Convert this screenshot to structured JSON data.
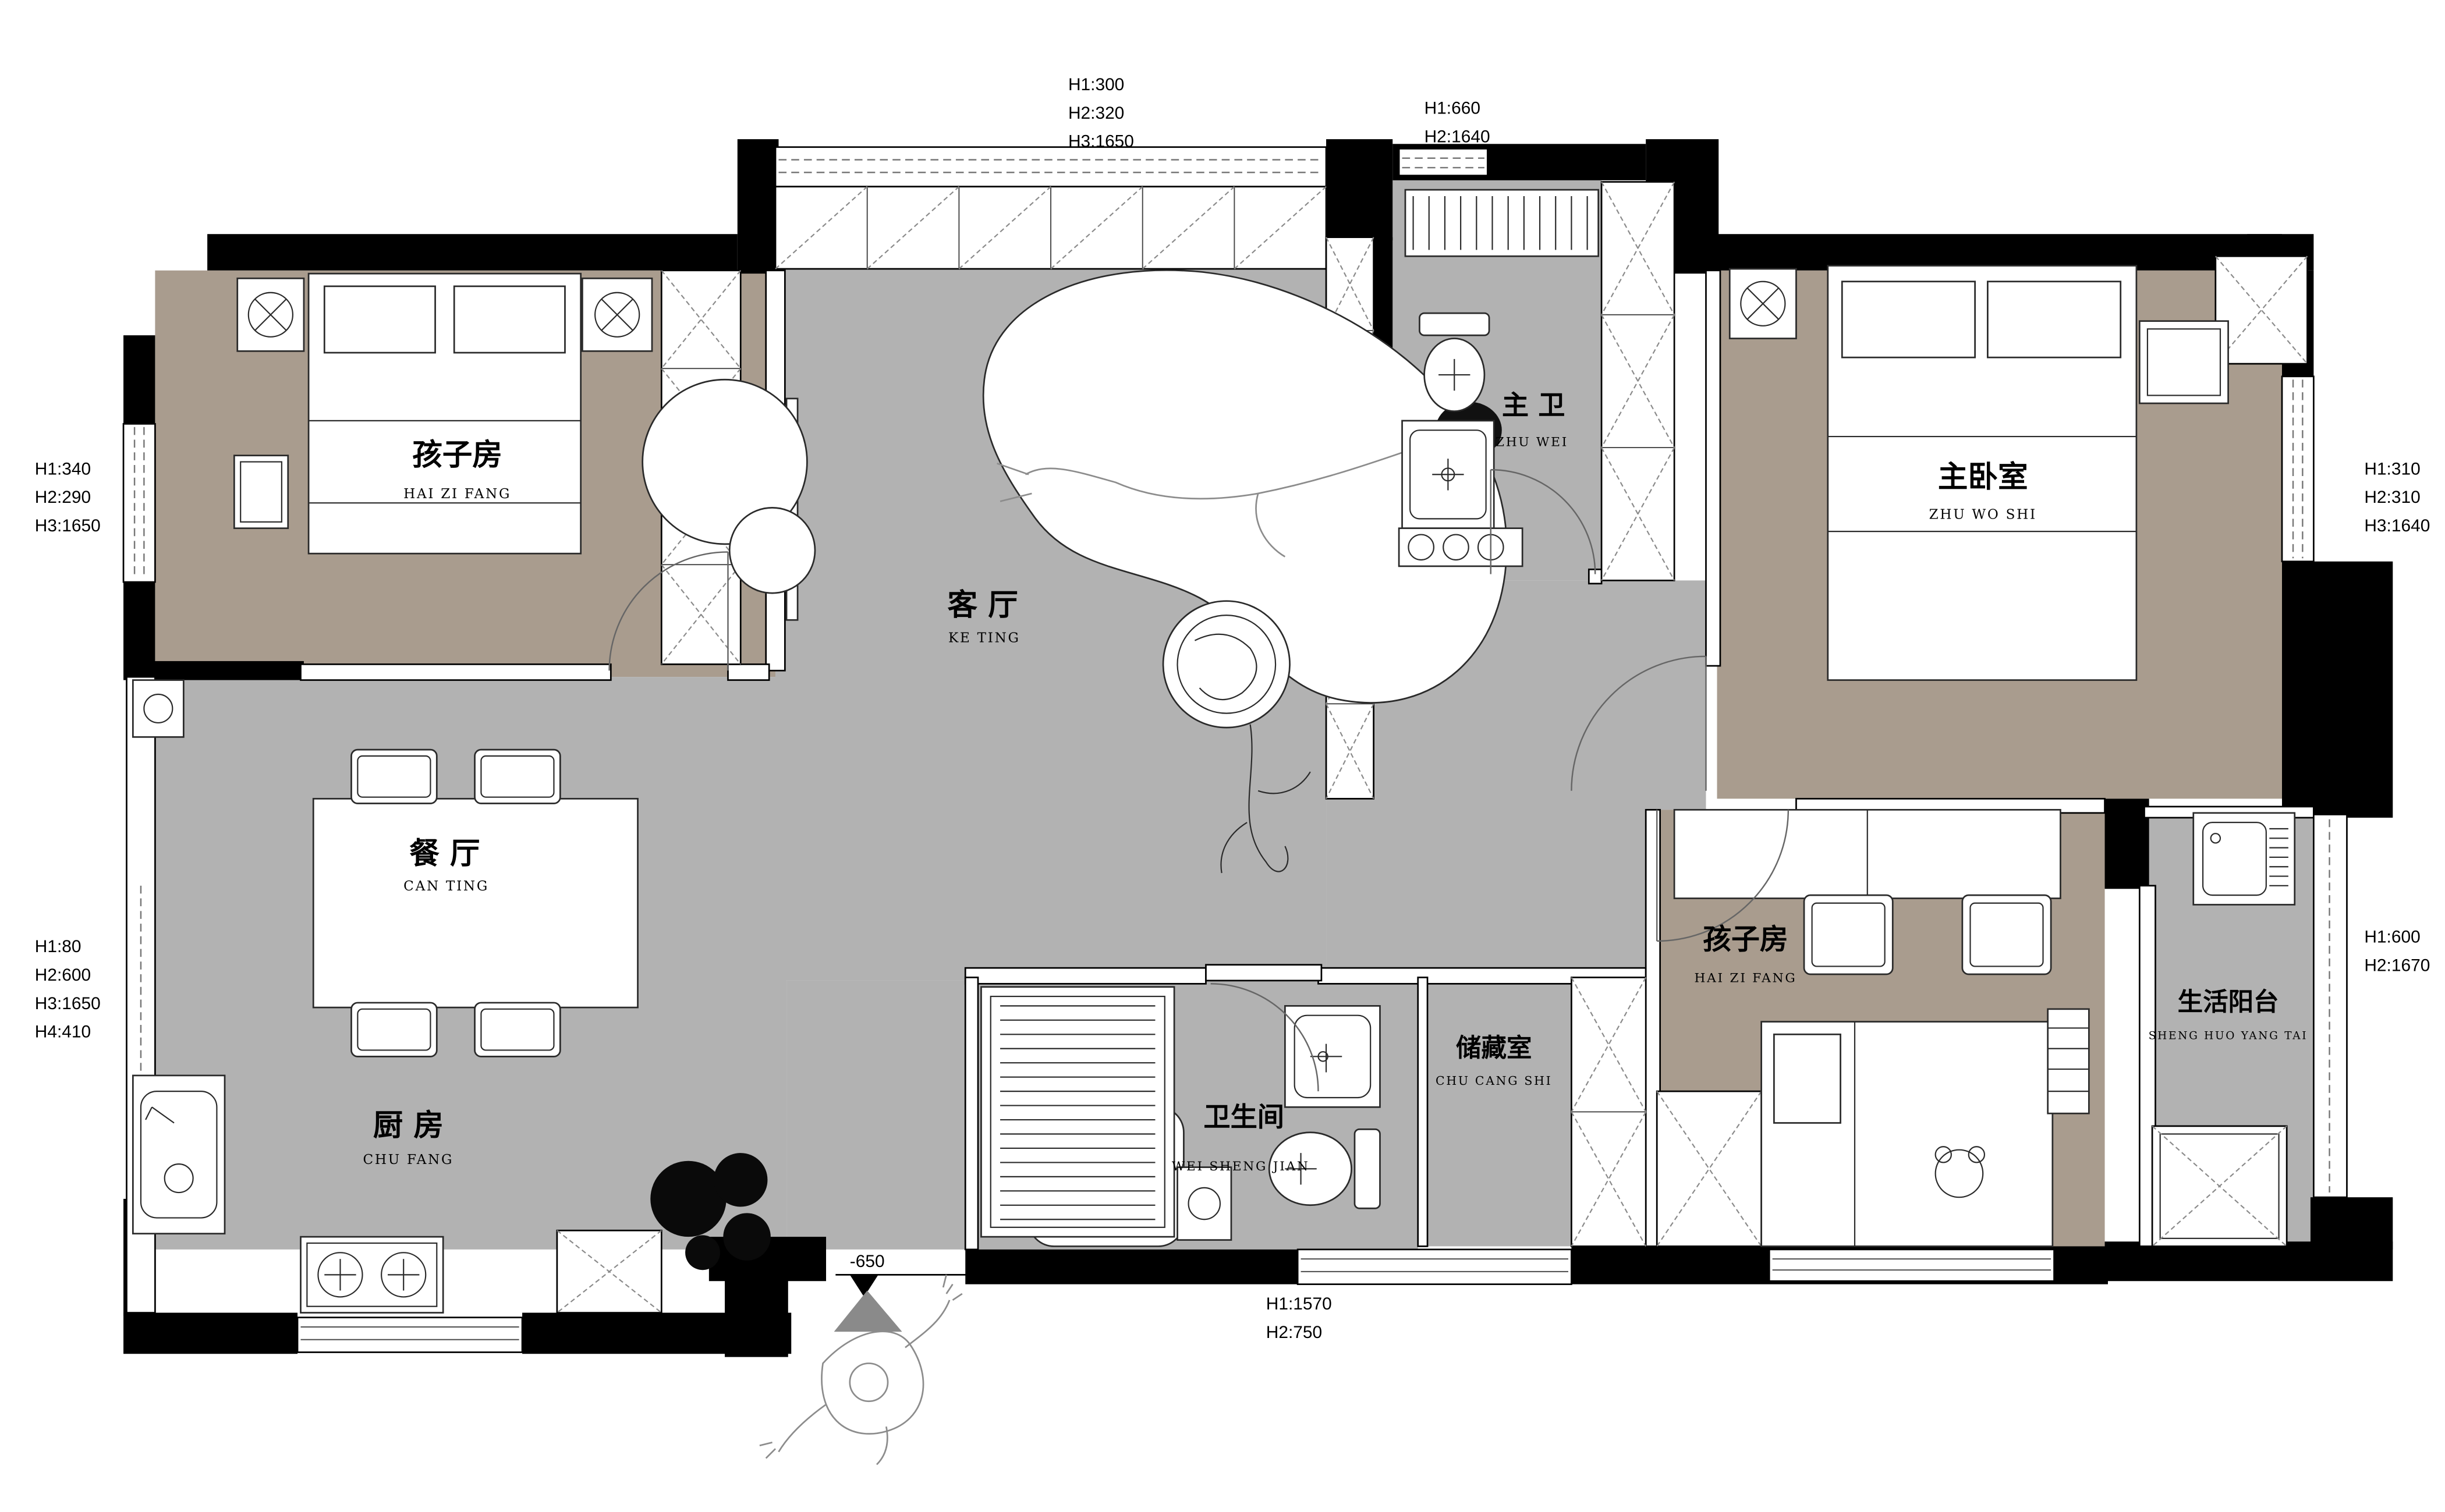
{
  "plan_type": "apartment-floor-plan",
  "rooms": {
    "child1": {
      "zh": "孩子房",
      "en": "HAI ZI FANG"
    },
    "living": {
      "zh": "客 厅",
      "en": "KE TING"
    },
    "masterBath": {
      "zh": "主 卫",
      "en": "ZHU WEI"
    },
    "master": {
      "zh": "主卧室",
      "en": "ZHU WO SHI"
    },
    "dining": {
      "zh": "餐 厅",
      "en": "CAN TING"
    },
    "kitchen": {
      "zh": "厨 房",
      "en": "CHU FANG"
    },
    "bath": {
      "zh": "卫生间",
      "en": "WEI SHENG JIAN"
    },
    "storage": {
      "zh": "储藏室",
      "en": "CHU CANG SHI"
    },
    "child2": {
      "zh": "孩子房",
      "en": "HAI ZI FANG"
    },
    "balcony": {
      "zh": "生活阳台",
      "en": "SHENG HUO YANG TAI"
    }
  },
  "annotations": {
    "top_center": [
      "H1:300",
      "H2:320",
      "H3:1650"
    ],
    "top_right": [
      "H1:660",
      "H2:1640"
    ],
    "left_upper": [
      "H1:340",
      "H2:290",
      "H3:1650"
    ],
    "left_lower": [
      "H1:80",
      "H2:600",
      "H3:1650",
      "H4:410"
    ],
    "right_upper": [
      "H1:310",
      "H2:310",
      "H3:1640"
    ],
    "right_lower": [
      "H1:600",
      "H2:1670"
    ],
    "bottom_center": [
      "H1:1570",
      "H2:750"
    ],
    "entry_level": "-650"
  },
  "colors": {
    "wall": "#000000",
    "floor_gray": "#b2b2b2",
    "floor_tan": "#a99c8e",
    "paper": "#ffffff"
  }
}
